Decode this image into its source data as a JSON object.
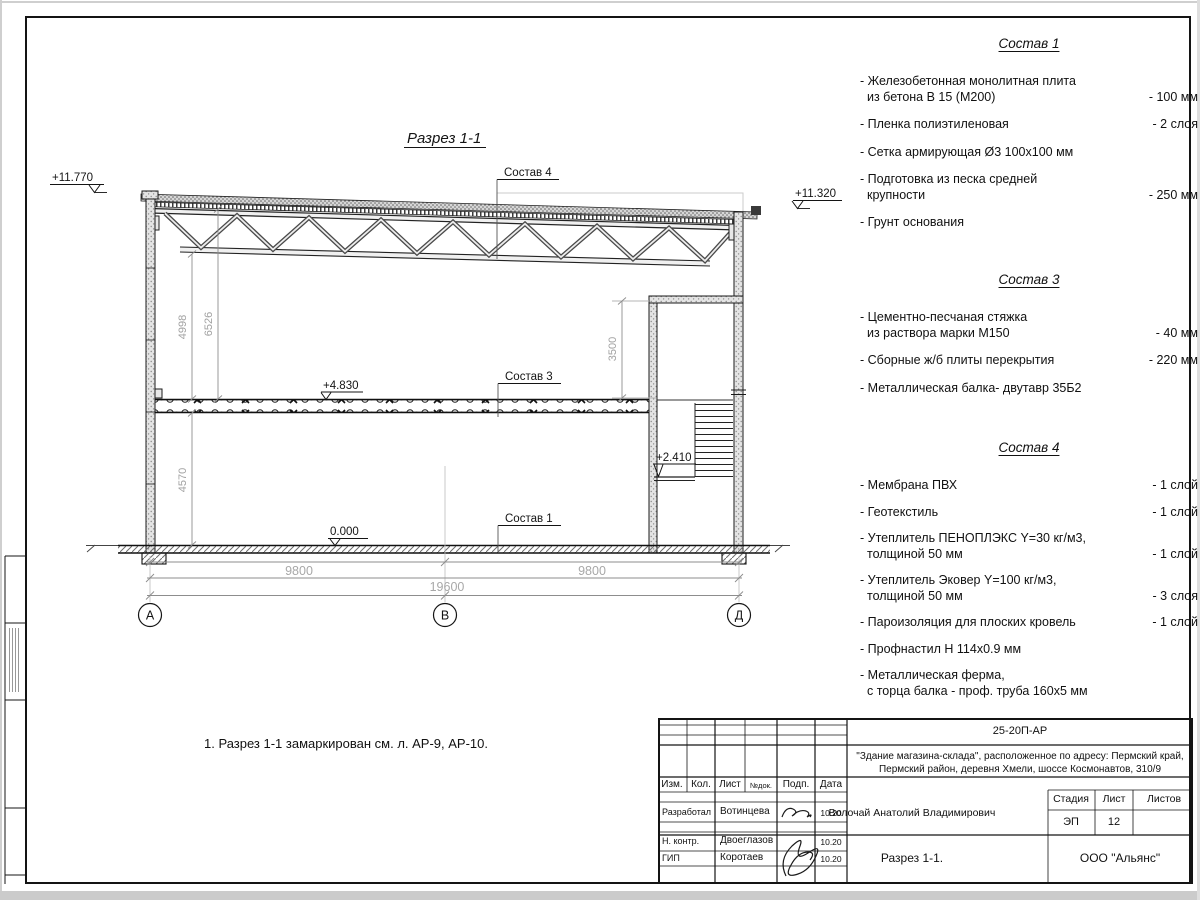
{
  "drawing": {
    "title": "Разрез 1-1",
    "note": "1. Разрез 1-1 замаркирован см. л. АР-9, АР-10.",
    "elevations": {
      "roof_left": "+11.770",
      "roof_right": "+11.320",
      "floor2": "+4.830",
      "landing": "+2.410",
      "ground": "0.000"
    },
    "dims": {
      "left_upper_1": "4998",
      "left_upper_2": "6526",
      "left_lower": "4570",
      "room_height": "3500",
      "span_left": "9800",
      "span_right": "9800",
      "total": "19600"
    },
    "axes": [
      "А",
      "В",
      "Д"
    ],
    "labels": {
      "sostav1": "Состав 1",
      "sostav3": "Состав 3",
      "sostav4": "Состав 4"
    }
  },
  "panels": [
    {
      "title": "Состав 1",
      "items": [
        {
          "lines": [
            "- Железобетонная монолитная плита",
            "из бетона В 15 (М200)"
          ],
          "value": "- 100 мм"
        },
        {
          "lines": [
            "- Пленка полиэтиленовая"
          ],
          "value": "- 2 слоя"
        },
        {
          "lines": [
            "- Сетка армирующая Ø3 100х100 мм"
          ],
          "value": ""
        },
        {
          "lines": [
            "- Подготовка из песка средней",
            "крупности"
          ],
          "value": "- 250 мм"
        },
        {
          "lines": [
            "- Грунт основания"
          ],
          "value": ""
        }
      ]
    },
    {
      "title": "Состав 3",
      "items": [
        {
          "lines": [
            "- Цементно-песчаная стяжка",
            "из раствора марки М150"
          ],
          "value": "- 40 мм"
        },
        {
          "lines": [
            "- Сборные ж/б плиты перекрытия"
          ],
          "value": "- 220 мм"
        },
        {
          "lines": [
            "- Металлическая балка- двутавр 35Б2"
          ],
          "value": ""
        }
      ]
    },
    {
      "title": "Состав 4",
      "items": [
        {
          "lines": [
            "- Мембрана ПВХ"
          ],
          "value": "- 1 слой"
        },
        {
          "lines": [
            "- Геотекстиль"
          ],
          "value": "- 1 слой"
        },
        {
          "lines": [
            "- Утеплитель ПЕНОПЛЭКС Y=30 кг/м3,",
            "толщиной 50 мм"
          ],
          "value": "- 1 слой"
        },
        {
          "lines": [
            "- Утеплитель Эковер Y=100 кг/м3,",
            "толщиной 50 мм"
          ],
          "value": "- 3 слоя"
        },
        {
          "lines": [
            "- Пароизоляция для плоских кровель"
          ],
          "value": "- 1 слой"
        },
        {
          "lines": [
            "- Профнастил Н 114х0.9 мм"
          ],
          "value": ""
        },
        {
          "lines": [
            "- Металлическая ферма,",
            "с торца балка - проф. труба 160х5 мм"
          ],
          "value": ""
        }
      ]
    }
  ],
  "titleblock": {
    "doc_number": "25-20П-АР",
    "project_line1": "\"Здание магазина-склада\", расположенное по адресу: Пермский край,",
    "project_line2": "Пермский район, деревня Хмели, шоссе Космонавтов, 310/9",
    "columns": {
      "izm": "Изм.",
      "kol": "Кол.",
      "list": "Лист",
      "ndoc": "№док.",
      "podp": "Подп.",
      "data": "Дата"
    },
    "rows": [
      {
        "role": "Разработал",
        "name": "Вотинцева",
        "date": "10.20"
      },
      {
        "role": "Н. контр.",
        "name": "Двоеглазов",
        "date": "10.20"
      },
      {
        "role": "ГИП",
        "name": "Коротаев",
        "date": "10.20"
      }
    ],
    "chief": "Волочай Анатолий Владимирович",
    "stage_label": "Стадия",
    "sheet_label": "Лист",
    "sheets_label": "Листов",
    "stage": "ЭП",
    "sheet": "12",
    "sheet_title": "Разрез 1-1.",
    "org": "ООО \"Альянс\""
  }
}
